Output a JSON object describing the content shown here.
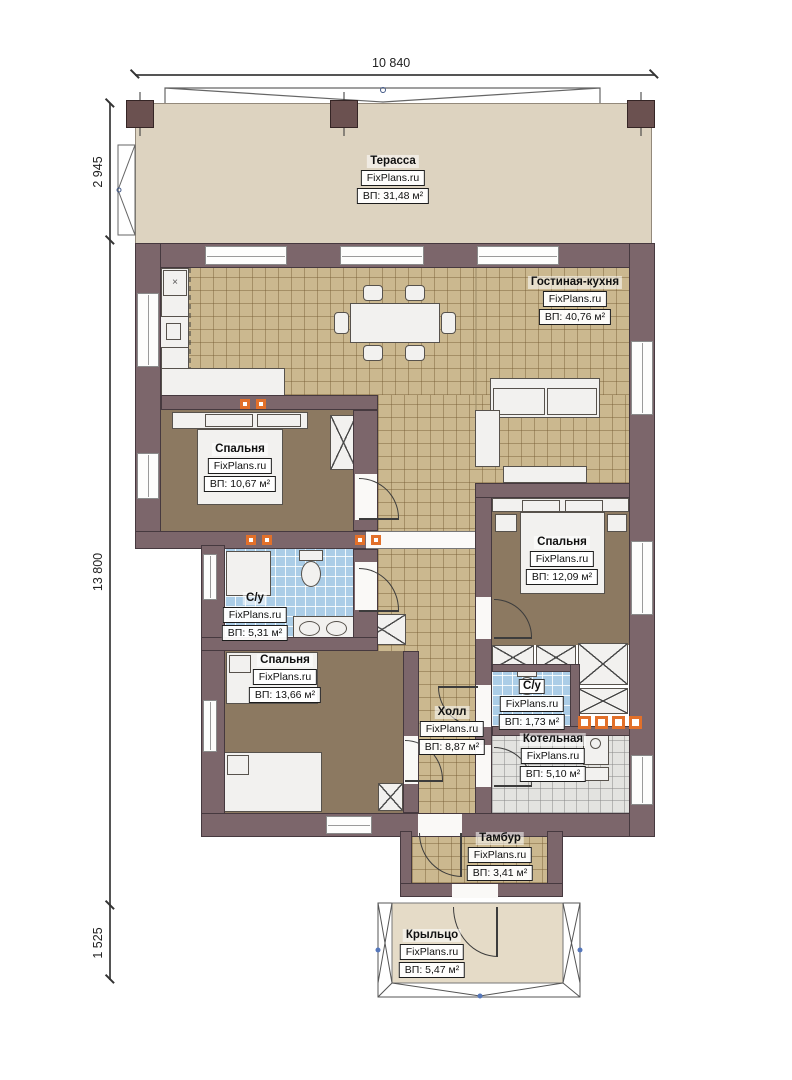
{
  "meta": {
    "watermark": "FixPlans.ru",
    "type": "floor-plan"
  },
  "dimensions": {
    "top": "10 840",
    "terrace": "2 945",
    "main": "13 800",
    "porch": "1 525"
  },
  "rooms": [
    {
      "id": "terrace",
      "name": "Терасса",
      "area": "ВП: 31,48 м²"
    },
    {
      "id": "living-kitchen",
      "name": "Гостиная-кухня",
      "area": "ВП: 40,76 м²"
    },
    {
      "id": "bedroom-1",
      "name": "Спальня",
      "area": "ВП: 10,67 м²"
    },
    {
      "id": "bathroom-1",
      "name": "С/у",
      "area": "ВП: 5,31 м²"
    },
    {
      "id": "bedroom-2",
      "name": "Спальня",
      "area": "ВП: 13,66 м²"
    },
    {
      "id": "bedroom-3",
      "name": "Спальня",
      "area": "ВП: 12,09 м²"
    },
    {
      "id": "hall",
      "name": "Холл",
      "area": "ВП: 8,87 м²"
    },
    {
      "id": "bathroom-2",
      "name": "С/у",
      "area": "ВП: 1,73 м²"
    },
    {
      "id": "boiler-room",
      "name": "Котельная",
      "area": "ВП: 5,10 м²"
    },
    {
      "id": "vestibule",
      "name": "Тамбур",
      "area": "ВП: 3,41 м²"
    },
    {
      "id": "porch",
      "name": "Крыльцо",
      "area": "ВП: 5,47 м²"
    }
  ],
  "colors": {
    "wall": "#7c666b",
    "tile": "#cbb88f",
    "carpet": "#8c7961",
    "bath_tile": "#abcde7",
    "boiler_tile": "#e3e3e0",
    "terrace": "#ddd3c0",
    "radiator": "#e2702a",
    "roof_dot": "#5577bb"
  }
}
